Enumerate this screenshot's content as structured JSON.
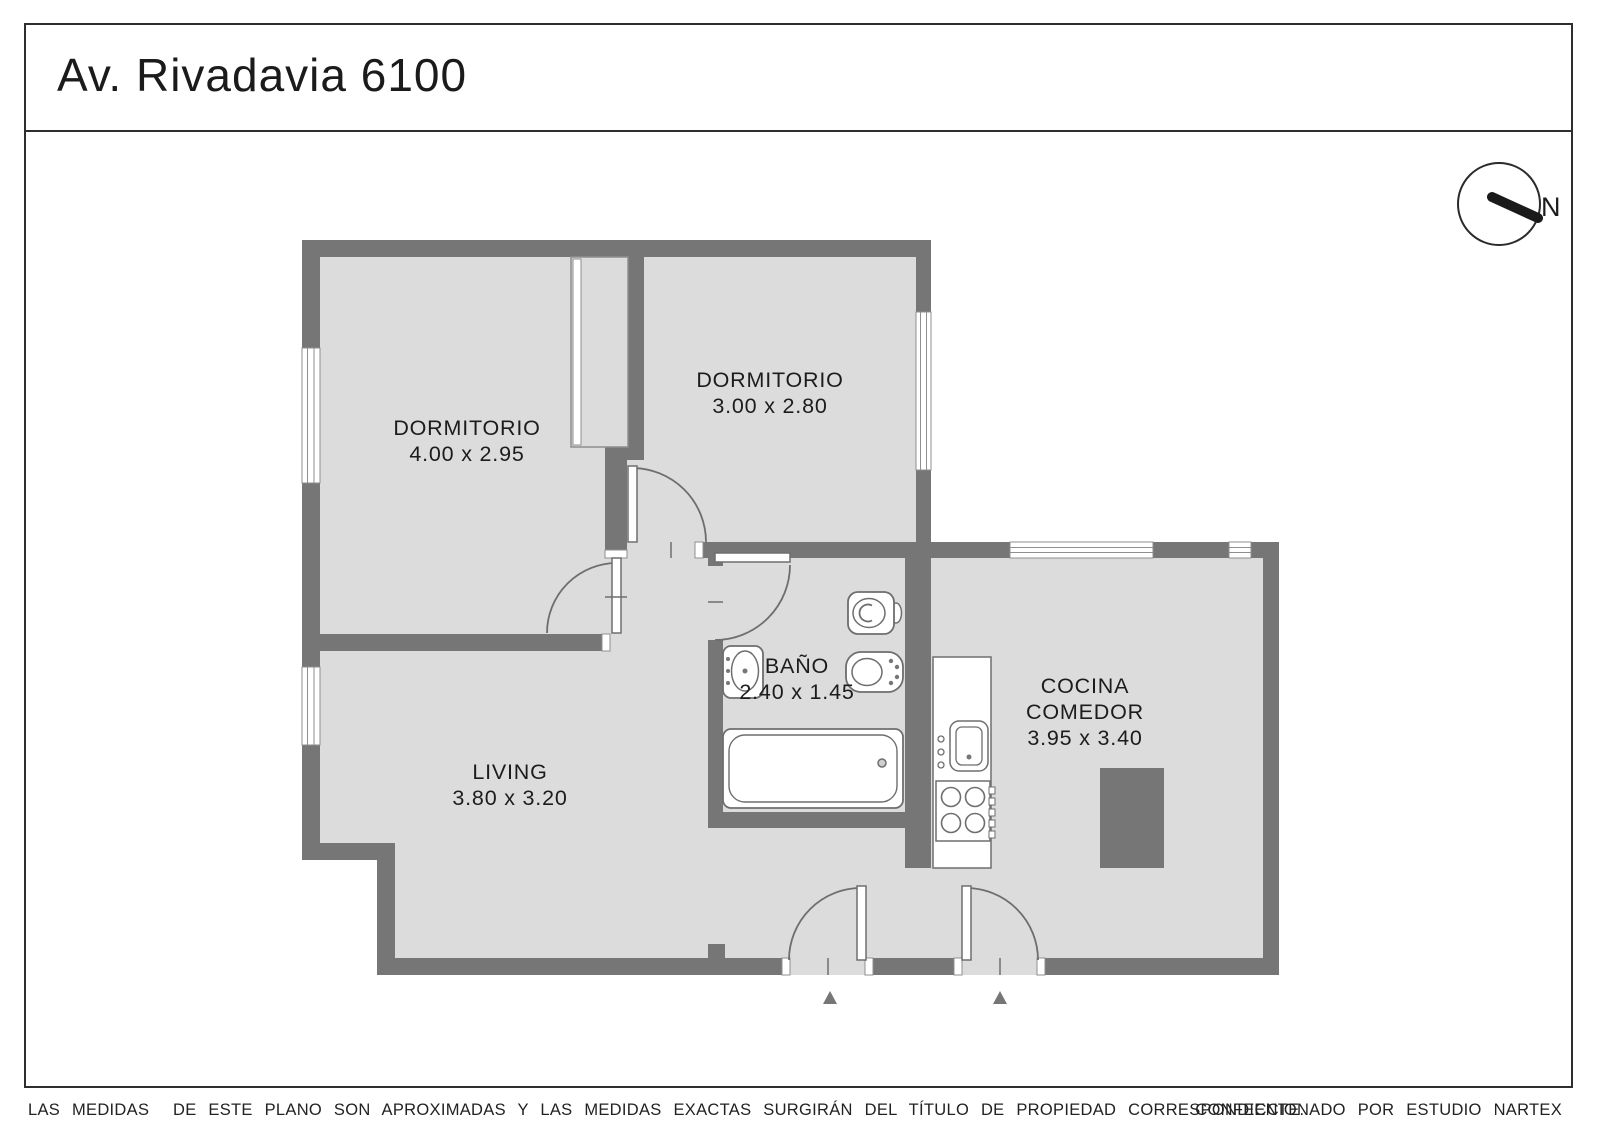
{
  "header": {
    "title": "Av. Rivadavia 6100"
  },
  "compass": {
    "label": "N"
  },
  "rooms": {
    "dormitorio1": {
      "name": "DORMITORIO",
      "dims": "4.00 x 2.95"
    },
    "dormitorio2": {
      "name": "DORMITORIO",
      "dims": "3.00 x 2.80"
    },
    "living": {
      "name": "LIVING",
      "dims": "3.80 x 3.20"
    },
    "bano": {
      "name": "BAÑO",
      "dims": "2.40 x 1.45"
    },
    "cocina": {
      "line1": "COCINA",
      "line2": "COMEDOR",
      "dims": "3.95 x 3.40"
    }
  },
  "fixtures": [
    "closet-icon",
    "toilet-icon",
    "bidet-icon",
    "bathroom-sink-icon",
    "bathtub-icon",
    "kitchen-sink-icon",
    "stove-icon",
    "dining-table-icon",
    "compass-icon",
    "entry-arrow-icon"
  ],
  "footer": {
    "disclaimer": "LAS MEDIDAS  DE ESTE PLANO SON APROXIMADAS Y LAS MEDIDAS EXACTAS SURGIRÁN DEL TÍTULO DE PROPIEDAD CORRESPONDIENTE.",
    "credit": "CONFECCIONADO POR ESTUDIO NARTEX"
  },
  "colors": {
    "wall": "#767676",
    "floor": "#dcdcdc",
    "outline": "#6e6e6e",
    "text": "#1a1a1a",
    "background": "#ffffff"
  }
}
